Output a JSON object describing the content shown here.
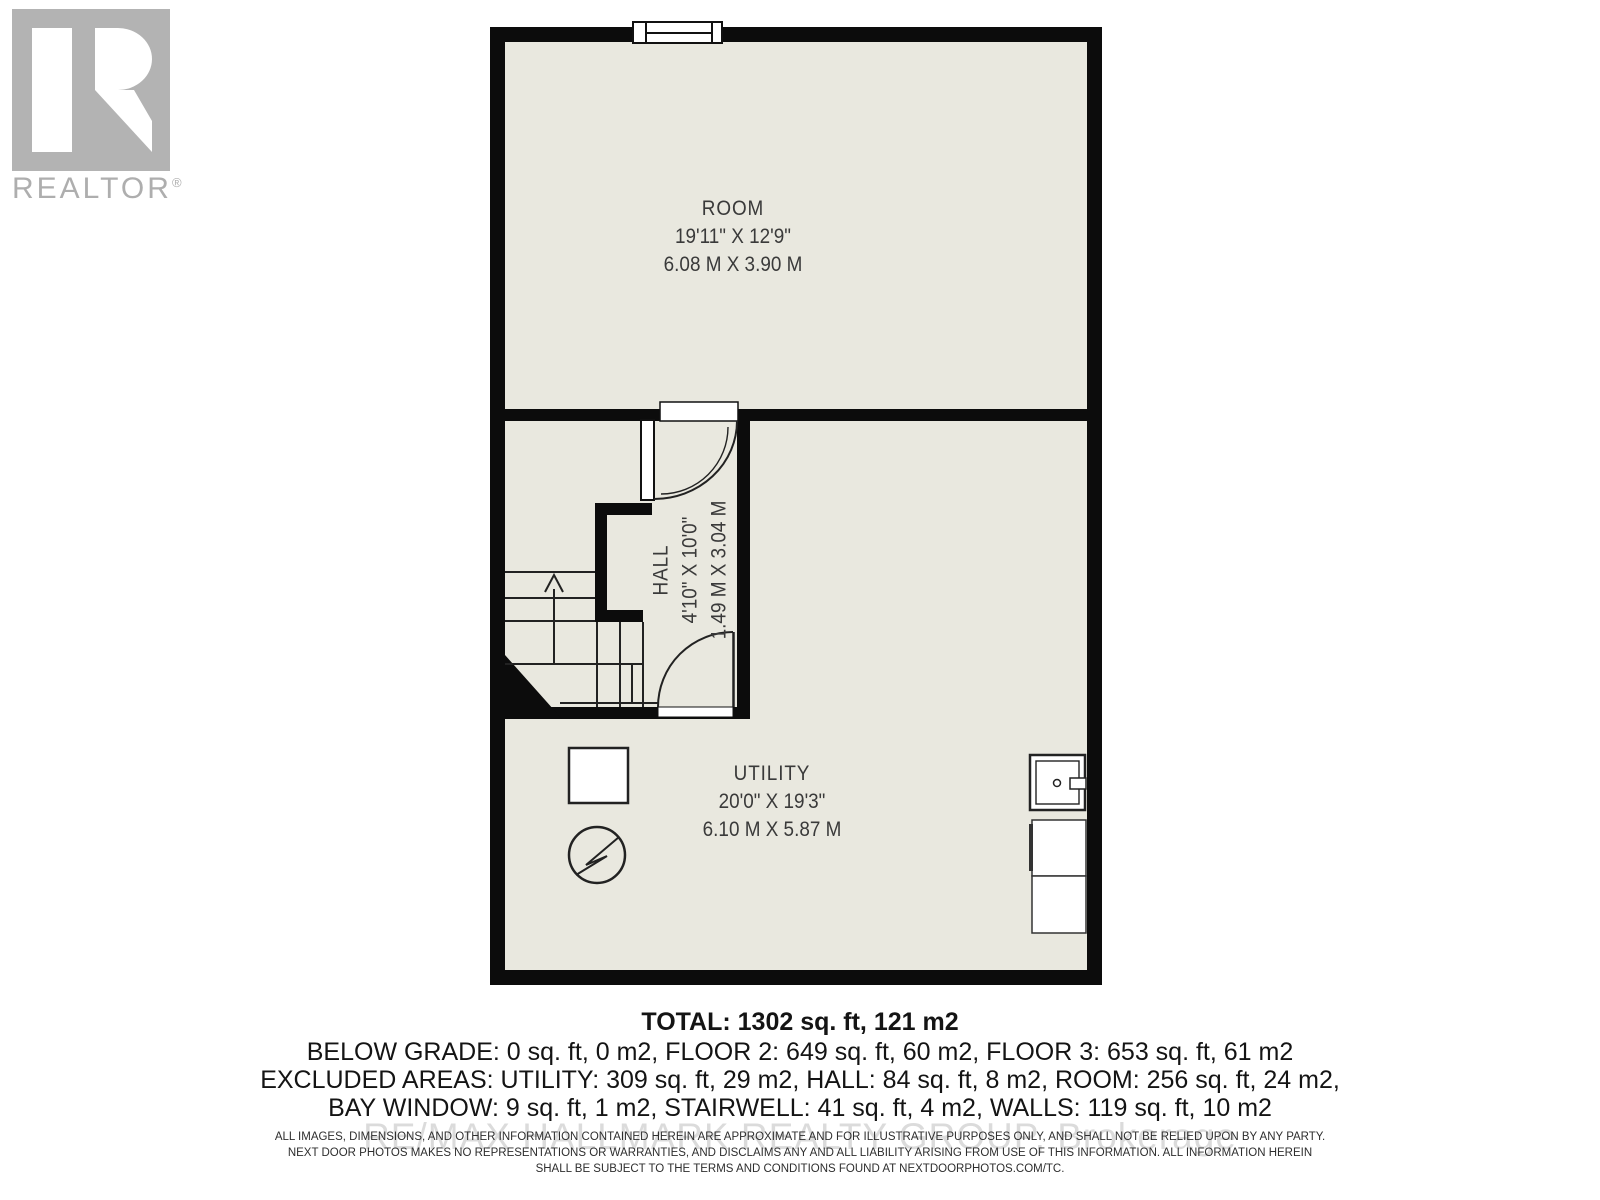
{
  "branding": {
    "logo_letter": "R",
    "logo_text": "REALTOR",
    "logo_registered": "®"
  },
  "floor_plan": {
    "rooms": [
      {
        "name": "ROOM",
        "dim_imperial": "19'11\" X 12'9\"",
        "dim_metric": "6.08 M X 3.90 M"
      },
      {
        "name": "HALL",
        "dim_imperial": "4'10\" X 10'0\"",
        "dim_metric": "1.49 M X 3.04 M"
      },
      {
        "name": "UTILITY",
        "dim_imperial": "20'0\" X 19'3\"",
        "dim_metric": "6.10 M X 5.87 M"
      }
    ],
    "colors": {
      "wall": "#0c0c0c",
      "floor_fill": "#e9e8df",
      "line": "#222222",
      "label_text": "#3a3a3a"
    }
  },
  "summary": {
    "total": "TOTAL: 1302 sq. ft, 121 m2",
    "line2": "BELOW GRADE: 0 sq. ft, 0 m2, FLOOR 2: 649 sq. ft, 60 m2, FLOOR 3: 653 sq. ft, 61 m2",
    "line3": "EXCLUDED AREAS: UTILITY: 309 sq. ft, 29 m2, HALL: 84 sq. ft, 8 m2, ROOM: 256 sq. ft, 24 m2,",
    "line4": "BAY WINDOW: 9 sq. ft, 1 m2, STAIRWELL: 41 sq. ft, 4 m2, WALLS: 119 sq. ft, 10 m2"
  },
  "watermark": "RE/MAX HALLMARK REALTY GROUP, Brokerage",
  "disclaimer": {
    "line1": "ALL IMAGES, DIMENSIONS, AND OTHER INFORMATION CONTAINED HEREIN ARE APPROXIMATE AND FOR ILLUSTRATIVE PURPOSES ONLY, AND SHALL NOT BE RELIED UPON BY ANY PARTY.",
    "line2": "NEXT DOOR PHOTOS MAKES NO REPRESENTATIONS OR WARRANTIES, AND DISCLAIMS ANY AND ALL LIABILITY ARISING FROM USE OF THIS INFORMATION. ALL INFORMATION HEREIN",
    "line3": "SHALL BE SUBJECT TO THE TERMS AND CONDITIONS FOUND AT NEXTDOORPHOTOS.COM/TC."
  }
}
